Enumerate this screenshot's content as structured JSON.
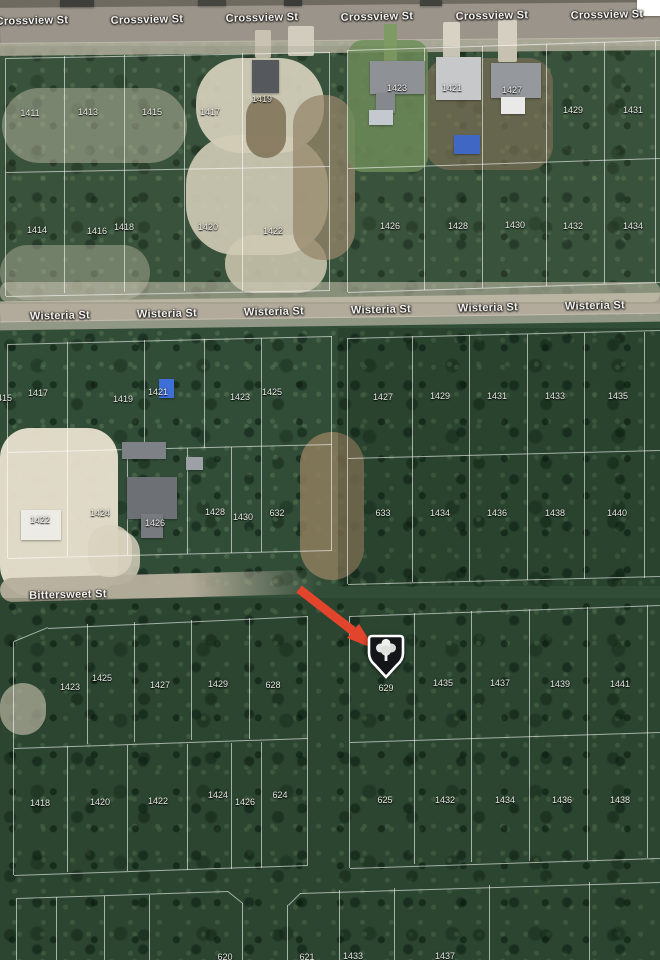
{
  "map": {
    "description": "Satellite aerial parcel map with lot numbers, street names and a red arrow pointing to marked lot 629",
    "colors": {
      "arrow": "#e2452c",
      "marker_fill": "#141518",
      "marker_border": "#ffffff",
      "parcel_line": "#ffffff",
      "vegetation": "#314d38",
      "road": "#9b948a",
      "sand": "#e7e0cd"
    },
    "streets": [
      {
        "name": "Crossview St",
        "labels": [
          [
            32,
            21
          ],
          [
            147,
            20
          ],
          [
            262,
            18
          ],
          [
            377,
            17
          ],
          [
            492,
            16
          ],
          [
            607,
            15
          ]
        ]
      },
      {
        "name": "Wisteria St",
        "labels": [
          [
            60,
            316
          ],
          [
            167,
            314
          ],
          [
            274,
            312
          ],
          [
            381,
            310
          ],
          [
            488,
            308
          ],
          [
            595,
            306
          ]
        ]
      },
      {
        "name": "Bittersweet St",
        "labels": [
          [
            68,
            595
          ]
        ]
      }
    ],
    "lots": [
      [
        "1411",
        30,
        113
      ],
      [
        "1413",
        88,
        112
      ],
      [
        "1415",
        152,
        112
      ],
      [
        "1417",
        210,
        112
      ],
      [
        "1419",
        262,
        99
      ],
      [
        "1423",
        397,
        88
      ],
      [
        "1421",
        452,
        88
      ],
      [
        "1427",
        512,
        90
      ],
      [
        "1429",
        573,
        110
      ],
      [
        "1431",
        633,
        110
      ],
      [
        "1414",
        37,
        230
      ],
      [
        "1416",
        97,
        231
      ],
      [
        "1418",
        124,
        227
      ],
      [
        "1420",
        208,
        227
      ],
      [
        "1422",
        273,
        231
      ],
      [
        "1426",
        390,
        226
      ],
      [
        "1428",
        458,
        226
      ],
      [
        "1430",
        515,
        225
      ],
      [
        "1432",
        573,
        226
      ],
      [
        "1434",
        633,
        226
      ],
      [
        "1415",
        2,
        398
      ],
      [
        "1417",
        38,
        393
      ],
      [
        "1419",
        123,
        399
      ],
      [
        "1421",
        158,
        392
      ],
      [
        "1423",
        240,
        397
      ],
      [
        "1425",
        272,
        392
      ],
      [
        "1427",
        383,
        397
      ],
      [
        "1429",
        440,
        396
      ],
      [
        "1431",
        497,
        396
      ],
      [
        "1433",
        555,
        396
      ],
      [
        "1435",
        618,
        396
      ],
      [
        "1422",
        40,
        520
      ],
      [
        "1424",
        100,
        513
      ],
      [
        "1426",
        155,
        523
      ],
      [
        "1428",
        215,
        512
      ],
      [
        "1430",
        243,
        517
      ],
      [
        "632",
        277,
        513
      ],
      [
        "633",
        383,
        513
      ],
      [
        "1434",
        440,
        513
      ],
      [
        "1436",
        497,
        513
      ],
      [
        "1438",
        555,
        513
      ],
      [
        "1440",
        617,
        513
      ],
      [
        "1423",
        70,
        687
      ],
      [
        "1425",
        102,
        678
      ],
      [
        "1427",
        160,
        685
      ],
      [
        "1429",
        218,
        684
      ],
      [
        "628",
        273,
        685
      ],
      [
        "629",
        386,
        688
      ],
      [
        "1435",
        443,
        683
      ],
      [
        "1437",
        500,
        683
      ],
      [
        "1439",
        560,
        684
      ],
      [
        "1441",
        620,
        684
      ],
      [
        "1418",
        40,
        803
      ],
      [
        "1420",
        100,
        802
      ],
      [
        "1422",
        158,
        801
      ],
      [
        "1424",
        218,
        795
      ],
      [
        "1426",
        245,
        802
      ],
      [
        "624",
        280,
        795
      ],
      [
        "625",
        385,
        800
      ],
      [
        "1432",
        445,
        800
      ],
      [
        "1434",
        505,
        800
      ],
      [
        "1436",
        562,
        800
      ],
      [
        "1438",
        620,
        800
      ],
      [
        "620",
        225,
        957
      ],
      [
        "621",
        307,
        957
      ],
      [
        "1433",
        353,
        956
      ],
      [
        "1437",
        445,
        956
      ]
    ],
    "marker": {
      "lot": "629",
      "x": 386,
      "y": 654
    },
    "arrow": {
      "color": "#e2452c",
      "from": [
        299,
        589
      ],
      "to": [
        375,
        649
      ]
    },
    "terrain": [
      {
        "n": "top-ground-strip",
        "x": 0,
        "y": 0,
        "w": 660,
        "h": 8,
        "c": "#6e6a60",
        "o": 1,
        "r": 0
      },
      {
        "n": "crossview-road",
        "x": 0,
        "y": 5,
        "w": 660,
        "h": 36,
        "c": "#9b948a",
        "o": 1,
        "r": 0,
        "rot": -0.5
      },
      {
        "n": "crossview-shoulder",
        "x": 0,
        "y": 40,
        "w": 660,
        "h": 13,
        "c": "#c6beae",
        "o": 0.8,
        "r": 0,
        "rot": -0.5
      },
      {
        "n": "wisteria-road",
        "x": 0,
        "y": 297,
        "w": 660,
        "h": 21,
        "c": "#b2ab9c",
        "o": 1,
        "r": 0,
        "rot": -0.75
      },
      {
        "n": "wisteria-shoulder",
        "x": 0,
        "y": 317,
        "w": 660,
        "h": 9,
        "c": "#d4ccba",
        "o": 0.6,
        "r": 0,
        "rot": -0.75
      },
      {
        "n": "sand-area",
        "x": 196,
        "y": 58,
        "w": 128,
        "h": 95,
        "c": "#e7e0cd",
        "o": 0.92,
        "r": 45
      },
      {
        "n": "sand-area",
        "x": 186,
        "y": 135,
        "w": 142,
        "h": 120,
        "c": "#e3dcc8",
        "o": 0.9,
        "r": 50
      },
      {
        "n": "sand-area",
        "x": 225,
        "y": 235,
        "w": 102,
        "h": 58,
        "c": "#e0d8c2",
        "o": 0.85,
        "r": 40
      },
      {
        "n": "sand-area",
        "x": 2,
        "y": 88,
        "w": 185,
        "h": 75,
        "c": "#d9d2bd",
        "o": 0.45,
        "r": 50
      },
      {
        "n": "sand-area",
        "x": 0,
        "y": 245,
        "w": 150,
        "h": 55,
        "c": "#d9d2bd",
        "o": 0.4,
        "r": 45
      },
      {
        "n": "sand-strip",
        "x": 0,
        "y": 282,
        "w": 660,
        "h": 20,
        "c": "#d8d1bf",
        "o": 0.55,
        "r": 8
      },
      {
        "n": "sand-area",
        "x": 0,
        "y": 428,
        "w": 118,
        "h": 168,
        "c": "#e9e2cf",
        "o": 0.95,
        "r": 30
      },
      {
        "n": "sand-area",
        "x": 95,
        "y": 530,
        "w": 45,
        "h": 55,
        "c": "#ddd6c2",
        "o": 0.8,
        "r": 40
      },
      {
        "n": "sand-area",
        "x": 0,
        "y": 683,
        "w": 46,
        "h": 52,
        "c": "#d6cfbb",
        "o": 0.7,
        "r": 40
      },
      {
        "n": "dirt-area",
        "x": 293,
        "y": 95,
        "w": 62,
        "h": 165,
        "c": "#9c8a6d",
        "o": 0.75,
        "r": 30
      },
      {
        "n": "dirt-area",
        "x": 246,
        "y": 96,
        "w": 40,
        "h": 62,
        "c": "#7c6a50",
        "o": 0.8,
        "r": 20
      },
      {
        "n": "dirt-area",
        "x": 300,
        "y": 432,
        "w": 64,
        "h": 148,
        "c": "#93805f",
        "o": 0.8,
        "r": 35
      },
      {
        "n": "dirt-yard",
        "x": 425,
        "y": 58,
        "w": 128,
        "h": 112,
        "c": "#8a775b",
        "o": 0.6,
        "r": 25
      },
      {
        "n": "lawn",
        "x": 348,
        "y": 40,
        "w": 80,
        "h": 132,
        "c": "#6f8f5a",
        "o": 0.85,
        "r": 15
      },
      {
        "n": "bittersweet-road",
        "x": 0,
        "y": 574,
        "w": 318,
        "h": 24,
        "c": "#b7af9d",
        "o": 0.95,
        "r": 12,
        "rot": -1.5,
        "grad": 1
      },
      {
        "n": "driveway",
        "x": 288,
        "y": 26,
        "w": 26,
        "h": 30,
        "c": "#d2ccbe",
        "o": 1,
        "r": 2
      },
      {
        "n": "driveway",
        "x": 255,
        "y": 30,
        "w": 16,
        "h": 28,
        "c": "#c9c2b2",
        "o": 1,
        "r": 2
      },
      {
        "n": "driveway",
        "x": 443,
        "y": 22,
        "w": 17,
        "h": 38,
        "c": "#d8d2c5",
        "o": 1,
        "r": 2
      },
      {
        "n": "driveway",
        "x": 498,
        "y": 20,
        "w": 19,
        "h": 42,
        "c": "#d5cfc1",
        "o": 1,
        "r": 2
      },
      {
        "n": "driveway-lawn",
        "x": 384,
        "y": 24,
        "w": 13,
        "h": 38,
        "c": "#7e9b63",
        "o": 1,
        "r": 2
      },
      {
        "n": "driveway",
        "x": 88,
        "y": 525,
        "w": 44,
        "h": 52,
        "c": "#d9d2c0",
        "o": 0.85,
        "r": 20
      },
      {
        "n": "shade-overlay",
        "x": 0,
        "y": 46,
        "w": 660,
        "h": 258,
        "c": "#6c7456",
        "o": 0.14,
        "r": 0
      },
      {
        "n": "shade-overlay",
        "x": 338,
        "y": 328,
        "w": 322,
        "h": 258,
        "c": "#04140a",
        "o": 0.18,
        "r": 0
      },
      {
        "n": "shade-overlay",
        "x": 0,
        "y": 598,
        "w": 660,
        "h": 362,
        "c": "#04120a",
        "o": 0.14,
        "r": 0
      }
    ],
    "buildings": [
      {
        "n": "vehicle",
        "x": 60,
        "y": 0,
        "w": 34,
        "h": 7,
        "c": "#3e3e3a"
      },
      {
        "n": "vehicle",
        "x": 198,
        "y": 0,
        "w": 28,
        "h": 6,
        "c": "#45453f"
      },
      {
        "n": "vehicle",
        "x": 284,
        "y": 0,
        "w": 18,
        "h": 6,
        "c": "#3b3b37"
      },
      {
        "n": "vehicle",
        "x": 420,
        "y": 0,
        "w": 22,
        "h": 6,
        "c": "#42423c"
      },
      {
        "n": "barn-lot-1419",
        "x": 252,
        "y": 60,
        "w": 27,
        "h": 33,
        "c": "#55595d"
      },
      {
        "n": "house-lot-1423",
        "x": 370,
        "y": 61,
        "w": 55,
        "h": 33,
        "c": "#8e9195"
      },
      {
        "n": "house-lot-1423-wing",
        "x": 376,
        "y": 93,
        "w": 19,
        "h": 20,
        "c": "#85888c"
      },
      {
        "n": "patio-lot-1423",
        "x": 369,
        "y": 110,
        "w": 24,
        "h": 15,
        "c": "#c3c9cf"
      },
      {
        "n": "house-lot-1421",
        "x": 436,
        "y": 57,
        "w": 45,
        "h": 43,
        "c": "#c6c8ca"
      },
      {
        "n": "house-lot-1427",
        "x": 491,
        "y": 63,
        "w": 50,
        "h": 35,
        "c": "#95989c"
      },
      {
        "n": "garage-lot-1427",
        "x": 501,
        "y": 97,
        "w": 24,
        "h": 17,
        "c": "#e9e9e7"
      },
      {
        "n": "blue-tarp",
        "x": 454,
        "y": 135,
        "w": 26,
        "h": 19,
        "c": "#4067c4"
      },
      {
        "n": "blue-shed",
        "x": 159,
        "y": 379,
        "w": 15,
        "h": 19,
        "c": "#3e6fd8"
      },
      {
        "n": "shed",
        "x": 122,
        "y": 442,
        "w": 44,
        "h": 17,
        "c": "#7e8286"
      },
      {
        "n": "shed",
        "x": 186,
        "y": 457,
        "w": 17,
        "h": 13,
        "c": "#9da1a5"
      },
      {
        "n": "house-lot-1426",
        "x": 127,
        "y": 477,
        "w": 50,
        "h": 42,
        "c": "#6d7175"
      },
      {
        "n": "house-lot-1426-wing",
        "x": 141,
        "y": 514,
        "w": 22,
        "h": 24,
        "c": "#777b7f"
      },
      {
        "n": "white-building-lot-1422",
        "x": 21,
        "y": 510,
        "w": 40,
        "h": 30,
        "c": "#edebe5"
      },
      {
        "n": "white-square-corner",
        "x": 637,
        "y": 0,
        "w": 23,
        "h": 16,
        "c": "#ffffff"
      }
    ],
    "parcel_lines": [
      [
        6,
        58,
        330,
        52
      ],
      [
        6,
        172,
        330,
        166
      ],
      [
        6,
        296,
        330,
        290
      ],
      [
        6,
        58,
        6,
        296
      ],
      [
        330,
        52,
        330,
        290
      ],
      [
        65,
        56,
        65,
        293
      ],
      [
        125,
        55,
        125,
        292
      ],
      [
        185,
        54,
        185,
        291
      ],
      [
        243,
        53,
        243,
        291
      ],
      [
        348,
        50,
        660,
        40
      ],
      [
        348,
        168,
        660,
        158
      ],
      [
        348,
        292,
        660,
        282
      ],
      [
        348,
        50,
        348,
        292
      ],
      [
        425,
        48,
        425,
        290
      ],
      [
        483,
        46,
        483,
        288
      ],
      [
        547,
        44,
        547,
        286
      ],
      [
        605,
        42,
        605,
        284
      ],
      [
        656,
        41,
        656,
        283
      ],
      [
        8,
        344,
        332,
        336
      ],
      [
        8,
        452,
        332,
        444
      ],
      [
        8,
        558,
        332,
        550
      ],
      [
        8,
        344,
        8,
        558
      ],
      [
        332,
        336,
        332,
        550
      ],
      [
        68,
        342,
        68,
        450
      ],
      [
        145,
        340,
        145,
        449
      ],
      [
        205,
        339,
        205,
        448
      ],
      [
        262,
        338,
        262,
        447
      ],
      [
        68,
        450,
        68,
        556
      ],
      [
        128,
        449,
        128,
        555
      ],
      [
        188,
        448,
        188,
        554
      ],
      [
        232,
        447,
        232,
        553
      ],
      [
        262,
        447,
        262,
        552
      ],
      [
        348,
        338,
        660,
        330
      ],
      [
        348,
        458,
        660,
        450
      ],
      [
        348,
        584,
        660,
        576
      ],
      [
        348,
        338,
        348,
        584
      ],
      [
        413,
        336,
        413,
        582
      ],
      [
        470,
        335,
        470,
        581
      ],
      [
        528,
        334,
        528,
        580
      ],
      [
        585,
        333,
        585,
        579
      ],
      [
        645,
        332,
        645,
        578
      ],
      [
        48,
        628,
        308,
        616
      ],
      [
        14,
        748,
        308,
        738
      ],
      [
        14,
        875,
        308,
        865
      ],
      [
        14,
        642,
        14,
        875
      ],
      [
        308,
        616,
        308,
        865
      ],
      [
        48,
        628,
        14,
        642
      ],
      [
        88,
        624,
        88,
        744
      ],
      [
        135,
        622,
        135,
        742
      ],
      [
        192,
        620,
        192,
        740
      ],
      [
        250,
        618,
        250,
        739
      ],
      [
        68,
        746,
        68,
        872
      ],
      [
        128,
        745,
        128,
        871
      ],
      [
        188,
        744,
        188,
        870
      ],
      [
        232,
        743,
        232,
        869
      ],
      [
        262,
        742,
        262,
        868
      ],
      [
        350,
        616,
        660,
        605
      ],
      [
        350,
        742,
        660,
        732
      ],
      [
        350,
        868,
        660,
        858
      ],
      [
        350,
        616,
        350,
        868
      ],
      [
        415,
        613,
        415,
        864
      ],
      [
        472,
        611,
        472,
        862
      ],
      [
        530,
        609,
        530,
        861
      ],
      [
        588,
        607,
        588,
        860
      ],
      [
        648,
        605,
        648,
        858
      ],
      [
        17,
        898,
        228,
        891
      ],
      [
        17,
        898,
        17,
        960
      ],
      [
        57,
        897,
        57,
        960
      ],
      [
        105,
        896,
        105,
        960
      ],
      [
        150,
        895,
        150,
        960
      ],
      [
        228,
        891,
        243,
        903
      ],
      [
        243,
        903,
        243,
        960
      ],
      [
        300,
        893,
        660,
        882
      ],
      [
        288,
        905,
        300,
        893
      ],
      [
        288,
        905,
        288,
        960
      ],
      [
        340,
        890,
        340,
        960
      ],
      [
        395,
        888,
        395,
        960
      ],
      [
        490,
        885,
        490,
        960
      ],
      [
        590,
        882,
        590,
        960
      ]
    ]
  }
}
